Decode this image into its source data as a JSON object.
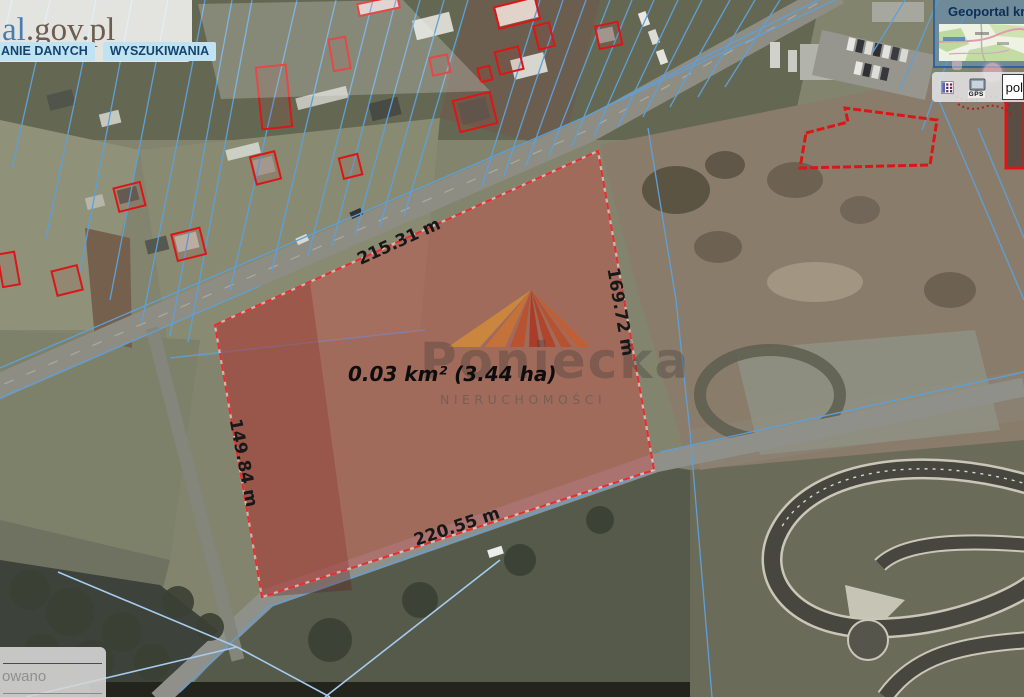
{
  "branding": {
    "logo_prefix": "al",
    "logo_suffix": ".gov.pl"
  },
  "nav_tabs": [
    {
      "label": "ANIE DANYCH"
    },
    {
      "label": "WYSZUKIWANIA"
    }
  ],
  "minimap": {
    "title": "Geoportal kra"
  },
  "toolbar": {
    "language_value": "pol",
    "gps_icon_label": "GPS"
  },
  "measurement": {
    "area_label": "0.03 km² (3.44 ha)",
    "sides": [
      {
        "id": "top",
        "label": "215.31 m"
      },
      {
        "id": "right",
        "label": "169.72 m"
      },
      {
        "id": "left",
        "label": "149.84 m"
      },
      {
        "id": "bottom",
        "label": "220.55 m"
      }
    ]
  },
  "watermark": {
    "brand": "Poniecka",
    "subtitle": "NIERUCHOMOŚCI"
  },
  "status_panel": {
    "text_fragment": "owano"
  },
  "colors": {
    "parcel_fill": "rgba(226,58,58,0.33)",
    "parcel_stroke": "#e23030",
    "cadastral_line": "#5f9fd8",
    "building_outline": "#dc1616",
    "tab_bg": "#bfe3f2",
    "tab_text": "#16436e",
    "watermark_orange": "#c97236"
  }
}
